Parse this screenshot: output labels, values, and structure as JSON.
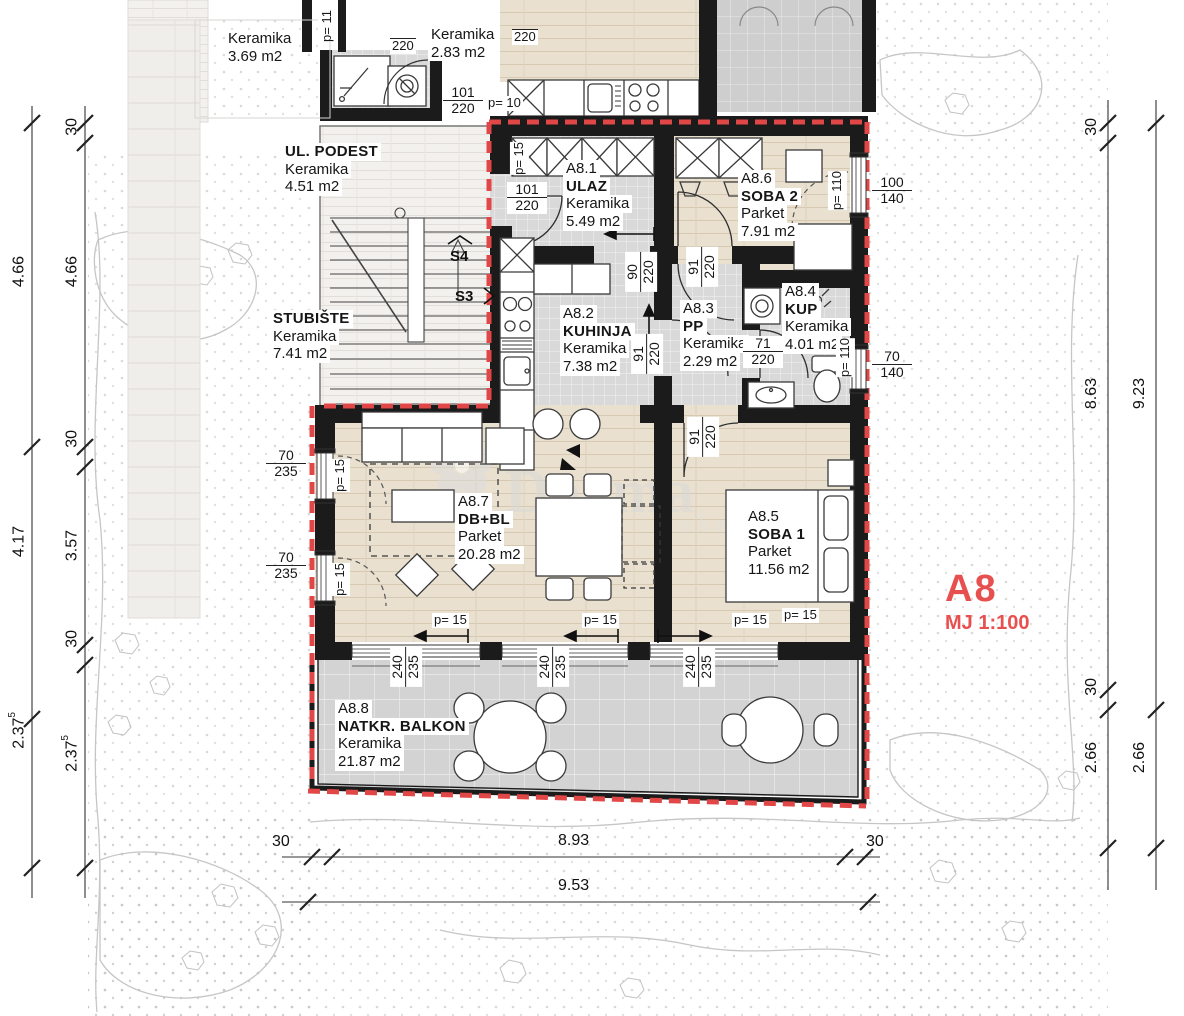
{
  "title_block": {
    "unit": "A8",
    "scale": "MJ 1:100"
  },
  "markers": {
    "s3": "S3",
    "s4": "S4"
  },
  "watermark": {
    "name": "Dogma",
    "sub": "nekretnine"
  },
  "colors": {
    "boundary_red": "#e14747",
    "label_red": "#e85050",
    "wall": "#1b1b1b"
  },
  "rooms": {
    "ulaz": {
      "code": "A8.1",
      "name": "ULAZ",
      "material": "Keramika",
      "area": "5.49 m2"
    },
    "kuhinja": {
      "code": "A8.2",
      "name": "KUHINJA",
      "material": "Keramika",
      "area": "7.38 m2"
    },
    "pp": {
      "code": "A8.3",
      "name": "PP",
      "material": "Keramika",
      "area": "2.29 m2"
    },
    "kup": {
      "code": "A8.4",
      "name": "KUP",
      "material": "Keramika",
      "area": "4.01 m2"
    },
    "soba1": {
      "code": "A8.5",
      "name": "SOBA 1",
      "material": "Parket",
      "area": "11.56 m2"
    },
    "soba2": {
      "code": "A8.6",
      "name": "SOBA 2",
      "material": "Parket",
      "area": "7.91 m2"
    },
    "dbbl": {
      "code": "A8.7",
      "name": "DB+BL",
      "material": "Parket",
      "area": "20.28 m2"
    },
    "balkon": {
      "code": "A8.8",
      "name": "NATKR. BALKON",
      "material": "Keramika",
      "area": "21.87 m2"
    },
    "podest": {
      "name": "UL. PODEST",
      "material": "Keramika",
      "area": "4.51 m2"
    },
    "stubiste": {
      "name": "STUBIŠTE",
      "material": "Keramika",
      "area": "7.41 m2"
    },
    "ker369": {
      "material": "Keramika",
      "area": "3.69 m2"
    },
    "ker283": {
      "material": "Keramika",
      "area": "2.83 m2"
    }
  },
  "dims": {
    "d220": "220",
    "f101": {
      "t": "101",
      "b": "220"
    },
    "f90": {
      "t": "90",
      "b": "220"
    },
    "f91": {
      "t": "91",
      "b": "220"
    },
    "f71": {
      "t": "71",
      "b": "220"
    },
    "f100_140": {
      "t": "100",
      "b": "140"
    },
    "f70_140": {
      "t": "70",
      "b": "140"
    },
    "f70_235": {
      "t": "70",
      "b": "235"
    },
    "f240_235": {
      "t": "240",
      "b": "235"
    },
    "p10": "p= 10",
    "p11": "p= 11",
    "p15": "p= 15",
    "p110": "p= 110"
  },
  "dim_chains": {
    "left_outer": [
      {
        "v": "4.66"
      },
      {
        "v": "4.17"
      },
      {
        "v": "2.37",
        "s": "5"
      }
    ],
    "left_inner": [
      {
        "v": "30"
      },
      {
        "v": "4.66"
      },
      {
        "v": "30"
      },
      {
        "v": "3.57"
      },
      {
        "v": "30"
      },
      {
        "v": "2.37",
        "s": "5"
      }
    ],
    "right_inner": [
      {
        "v": "30"
      },
      {
        "v": "8.63"
      },
      {
        "v": "30"
      },
      {
        "v": "2.66"
      }
    ],
    "right_outer": [
      {
        "v": "9.23"
      },
      {
        "v": "2.66"
      }
    ],
    "bottom_inner": [
      {
        "v": "30"
      },
      {
        "v": "8.93"
      },
      {
        "v": "30"
      }
    ],
    "bottom_outer": [
      {
        "v": "9.53"
      }
    ]
  }
}
